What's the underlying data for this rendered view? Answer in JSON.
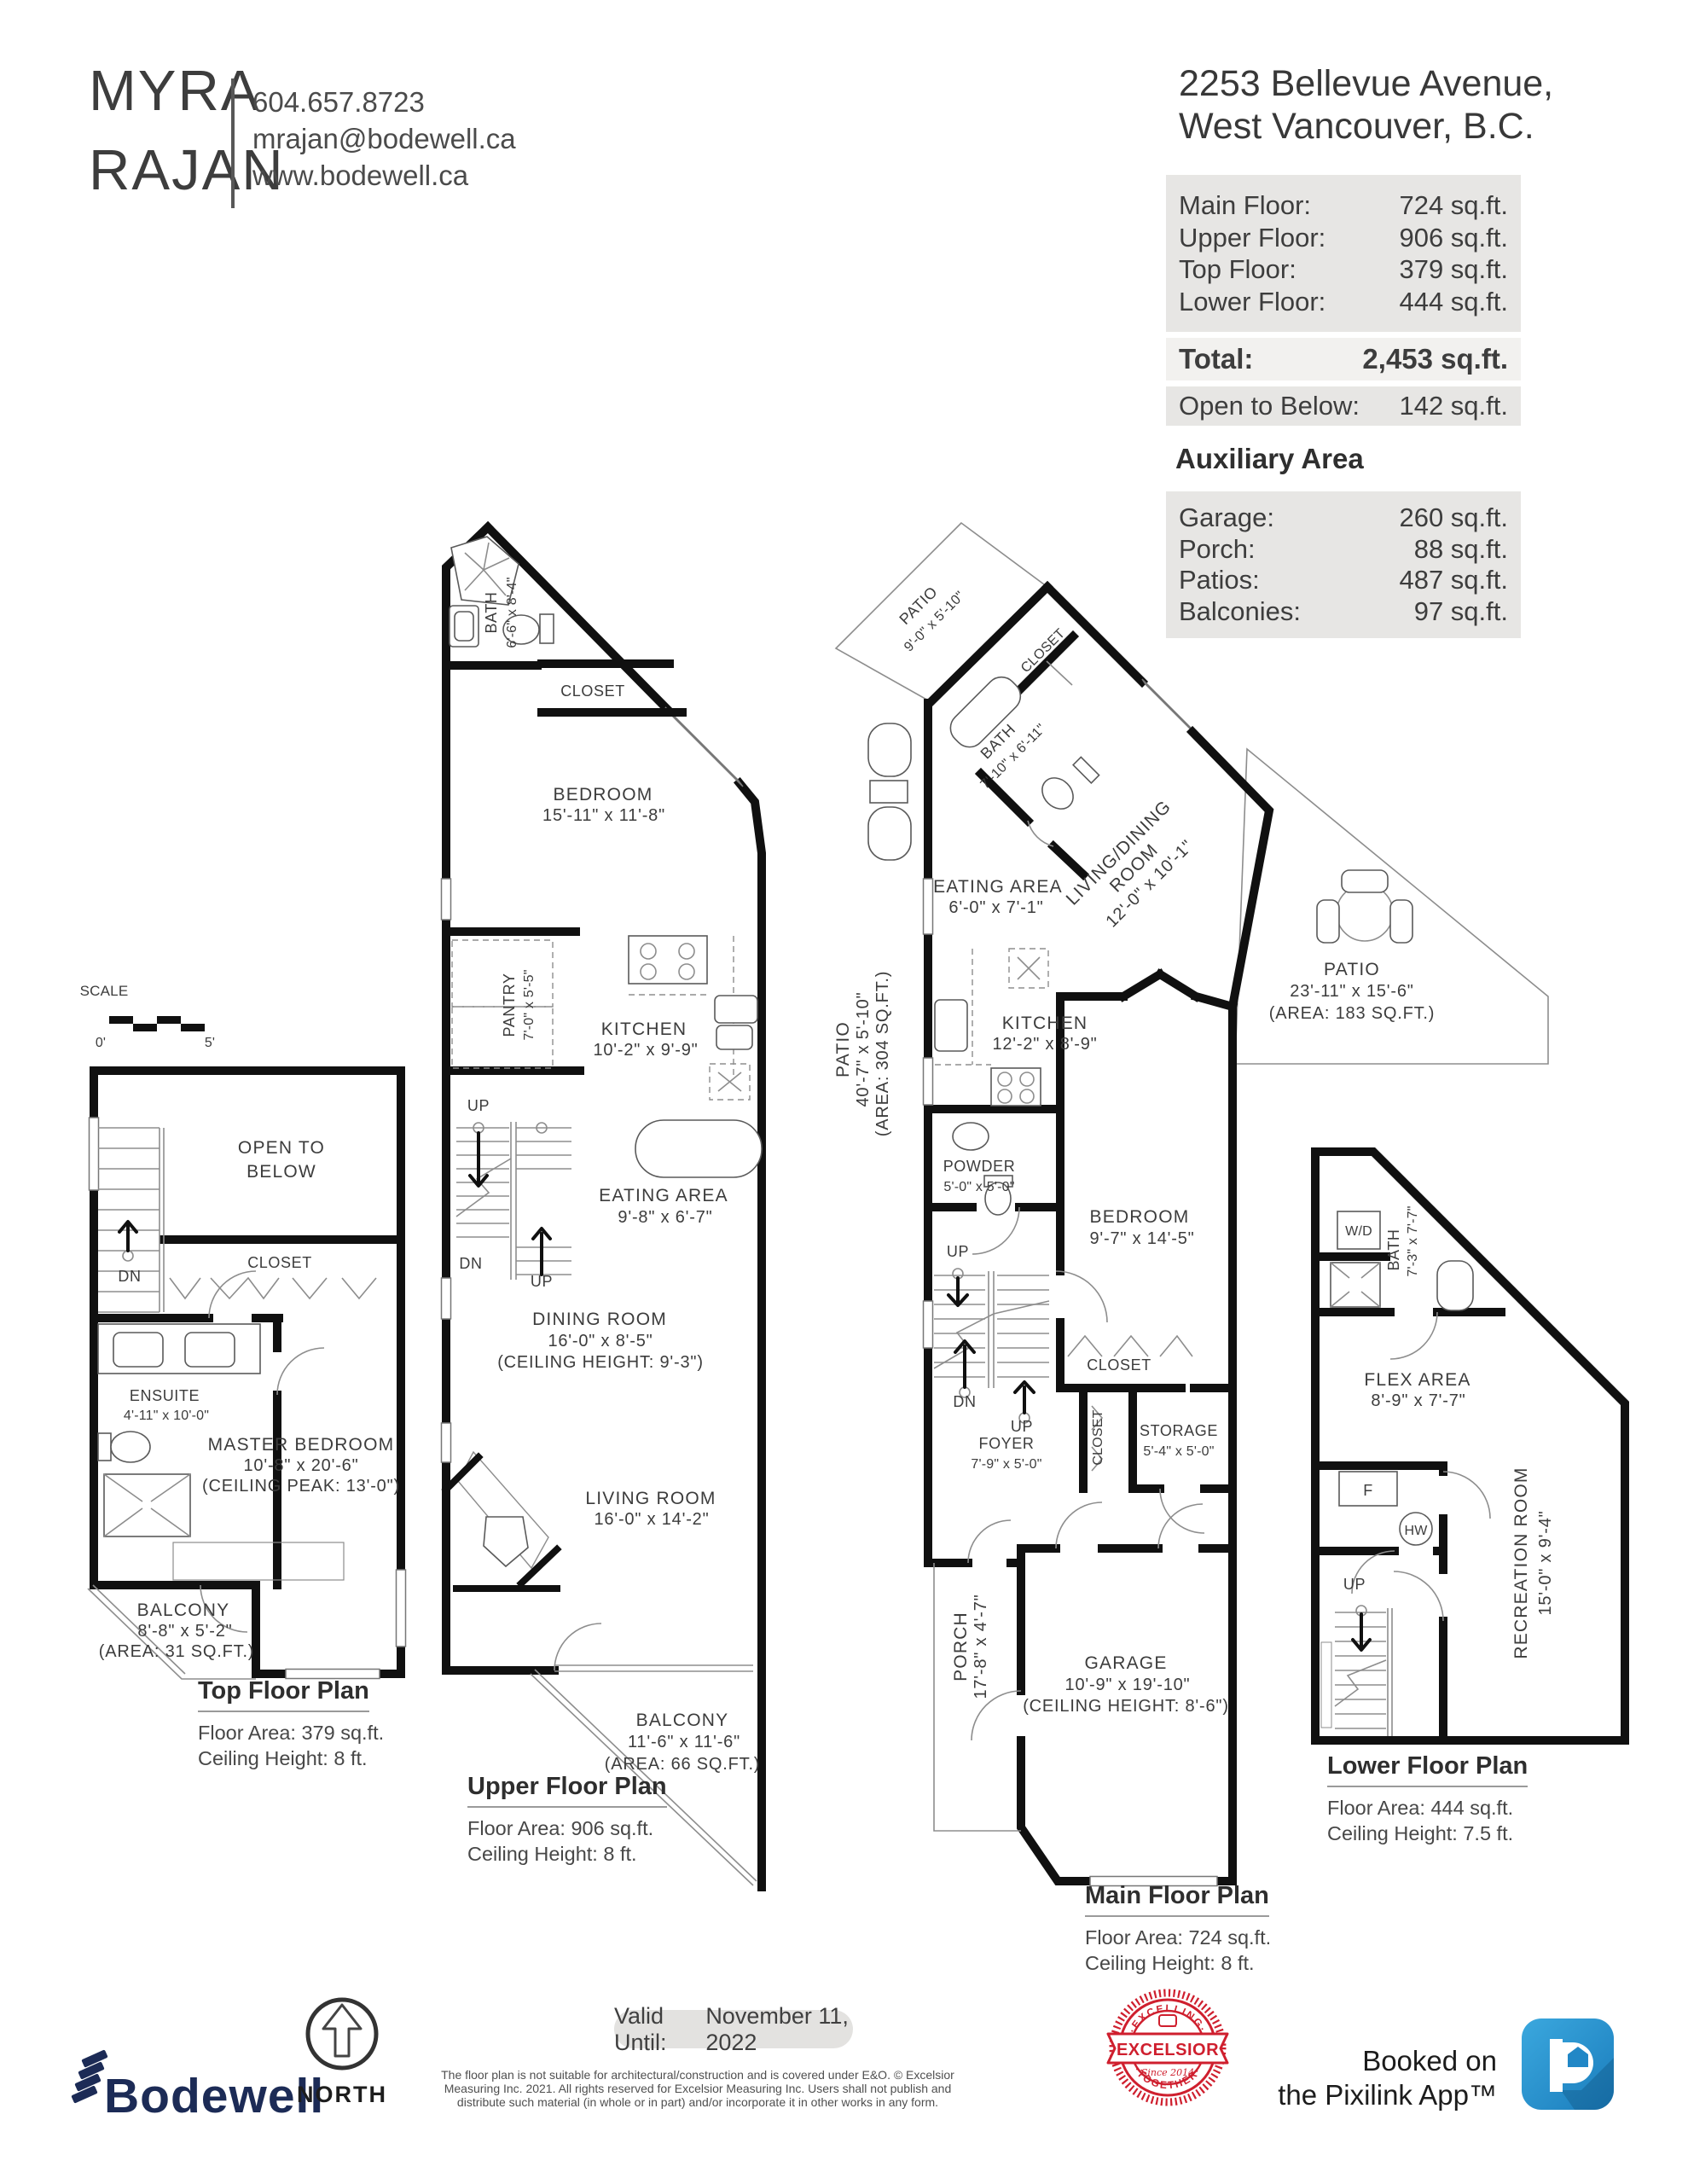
{
  "header": {
    "agent_first": "MYRA",
    "agent_last": "RAJAN",
    "phone": "604.657.8723",
    "email": "mrajan@bodewell.ca",
    "website": "www.bodewell.ca",
    "address_line1": "2253 Bellevue Avenue,",
    "address_line2": "West Vancouver, B.C."
  },
  "area_summary": {
    "floors": [
      {
        "label": "Main Floor:",
        "value": "724 sq.ft."
      },
      {
        "label": "Upper Floor:",
        "value": "906 sq.ft."
      },
      {
        "label": "Top Floor:",
        "value": "379 sq.ft."
      },
      {
        "label": "Lower Floor:",
        "value": "444 sq.ft."
      }
    ],
    "total_label": "Total:",
    "total_value": "2,453 sq.ft.",
    "open_label": "Open to Below:",
    "open_value": "142 sq.ft.",
    "aux_heading": "Auxiliary Area",
    "aux": [
      {
        "label": "Garage:",
        "value": "260 sq.ft."
      },
      {
        "label": "Porch:",
        "value": "88 sq.ft."
      },
      {
        "label": "Patios:",
        "value": "487 sq.ft."
      },
      {
        "label": "Balconies:",
        "value": "97 sq.ft."
      }
    ]
  },
  "scale": {
    "label": "SCALE",
    "zero": "0'",
    "five": "5'"
  },
  "top_plan": {
    "open1": "OPEN TO",
    "open2": "BELOW",
    "closet": "CLOSET",
    "dn": "DN",
    "ensuite": "ENSUITE",
    "ensuite_dims": "4'-11\" x 10'-0\"",
    "master1": "MASTER BEDROOM",
    "master2": "10'-8\" x 20'-6\"",
    "master3": "(CEILING PEAK: 13'-0\")",
    "balcony": "BALCONY",
    "balcony_dims": "8'-8\" x 5'-2\"",
    "balcony_area": "(AREA: 31 SQ.FT.)",
    "caption": "Top Floor Plan",
    "area": "Floor Area: 379 sq.ft.",
    "ceiling": "Ceiling Height: 8 ft."
  },
  "upper_plan": {
    "bath": "BATH",
    "bath_dims": "6'-6\" x 8'-4\"",
    "closet": "CLOSET",
    "bedroom": "BEDROOM",
    "bedroom_dims": "15'-11\" x 11'-8\"",
    "pantry": "PANTRY",
    "pantry_dims": "7'-0\" x 5'-5\"",
    "kitchen": "KITCHEN",
    "kitchen_dims": "10'-2\" x 9'-9\"",
    "up1": "UP",
    "dn": "DN",
    "up2": "UP",
    "eating": "EATING AREA",
    "eating_dims": "9'-8\" x 6'-7\"",
    "dining1": "DINING ROOM",
    "dining2": "16'-0\" x 8'-5\"",
    "dining3": "(CEILING HEIGHT: 9'-3\")",
    "living": "LIVING ROOM",
    "living_dims": "16'-0\" x 14'-2\"",
    "balcony": "BALCONY",
    "balcony_dims": "11'-6\" x 11'-6\"",
    "balcony_area": "(AREA: 66 SQ.FT.)",
    "caption": "Upper Floor Plan",
    "area": "Floor Area: 906 sq.ft.",
    "ceiling": "Ceiling Height: 8 ft."
  },
  "main_plan": {
    "patio_nw": "PATIO",
    "patio_nw_dims": "9'-0\" x 5'-10\"",
    "closet_nw": "CLOSET",
    "bath": "BATH",
    "bath_dims": "7'-10\" x 6'-11\"",
    "ld1": "LIVING/DINING",
    "ld2": "ROOM",
    "ld3": "12'-0\" x 10'-1\"",
    "patio_e": "PATIO",
    "patio_e_dims": "23'-11\" x 15'-6\"",
    "patio_e_area": "(AREA: 183 SQ.FT.)",
    "eating": "EATING AREA",
    "eating_dims": "6'-0\" x 7'-1\"",
    "kitchen": "KITCHEN",
    "kitchen_dims": "12'-2\" x 8'-9\"",
    "patio_w": "PATIO",
    "patio_w_dims": "40'-7\" x 5'-10\"",
    "patio_w_area": "(AREA: 304 SQ.FT.)",
    "powder": "POWDER",
    "powder_dims": "5'-0\" x 5'-0\"",
    "bedroom": "BEDROOM",
    "bedroom_dims": "9'-7\" x 14'-5\"",
    "closet1": "CLOSET",
    "closet2": "CLOSET",
    "storage": "STORAGE",
    "storage_dims": "5'-4\" x 5'-0\"",
    "up1": "UP",
    "dn": "DN",
    "up2": "UP",
    "foyer": "FOYER",
    "foyer_dims": "7'-9\" x 5'-0\"",
    "porch": "PORCH",
    "porch_dims": "17'-8\" x 4'-7\"",
    "garage": "GARAGE",
    "garage_dims": "10'-9\" x 19'-10\"",
    "garage_ceiling": "(CEILING HEIGHT: 8'-6\")",
    "caption": "Main Floor Plan",
    "area": "Floor Area: 724 sq.ft.",
    "ceiling": "Ceiling Height: 8 ft."
  },
  "lower_plan": {
    "wd": "W/D",
    "bath": "BATH",
    "bath_dims": "7'-3\" x 7'-7\"",
    "flex": "FLEX AREA",
    "flex_dims": "8'-9\" x 7'-7\"",
    "f": "F",
    "hw": "HW",
    "up": "UP",
    "rec": "RECREATION ROOM",
    "rec_dims": "15'-0\" x 9'-4\"",
    "caption": "Lower Floor Plan",
    "area": "Floor Area: 444 sq.ft.",
    "ceiling": "Ceiling Height: 7.5 ft."
  },
  "footer": {
    "brand": "Bodewell",
    "north": "NORTH",
    "valid_label": "Valid Until:",
    "valid_date": "November 11, 2022",
    "disclaimer": [
      "The floor plan is not suitable for architectural/construction and is covered under E&O. © Excelsior",
      "Measuring Inc. 2021. All rights reserved for Excelsior Measuring Inc. Users shall not publish and",
      "distribute such material (in whole or in part) and/or incorporate it in other works in any form."
    ],
    "stamp_top": "·EXCELLING·",
    "stamp_mid": "EXCELSIOR",
    "stamp_bottom": "·TOGETHER·",
    "stamp_since": "Since 2014",
    "booked1": "Booked on",
    "booked2": "the Pixilink App™",
    "p_glyph": "p"
  },
  "colors": {
    "wall": "#101010",
    "brand_navy": "#1c2b56",
    "north_red": "#d8404d",
    "stamp_red": "#cf1f2e",
    "pixilink_blue": "#2187c6",
    "table_bg": "#e7e6e4"
  }
}
